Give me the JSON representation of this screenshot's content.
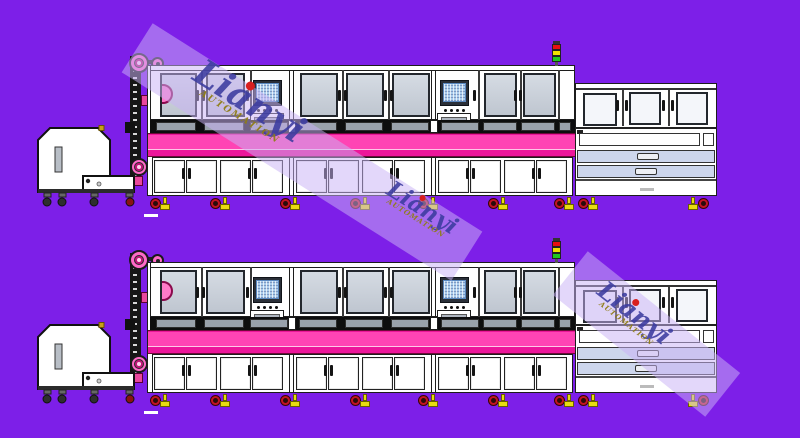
{
  "watermark": {
    "brand": "Lianyi",
    "subtitle": "AUTOMATION"
  },
  "colors": {
    "background": "#7D1FE8",
    "conveyor_pink": "#FF44B4",
    "conveyor_deep_pink": "#EC169A",
    "pulley_pink": "#FF6AC8",
    "window_gray": "#C9CFD8",
    "drawer_blue": "#CDD6EC",
    "caster_red": "#C41422",
    "foot_yellow": "#E8DC10",
    "signal_red": "#E81010",
    "signal_yellow": "#F0E000",
    "signal_green": "#20C820",
    "watermark_text": "#3C3CA0",
    "watermark_subtitle": "#8F7D17"
  },
  "rows": [
    {
      "name": "machine-line-row-top",
      "top": 40
    },
    {
      "name": "machine-line-row-bottom",
      "top": 237
    }
  ]
}
